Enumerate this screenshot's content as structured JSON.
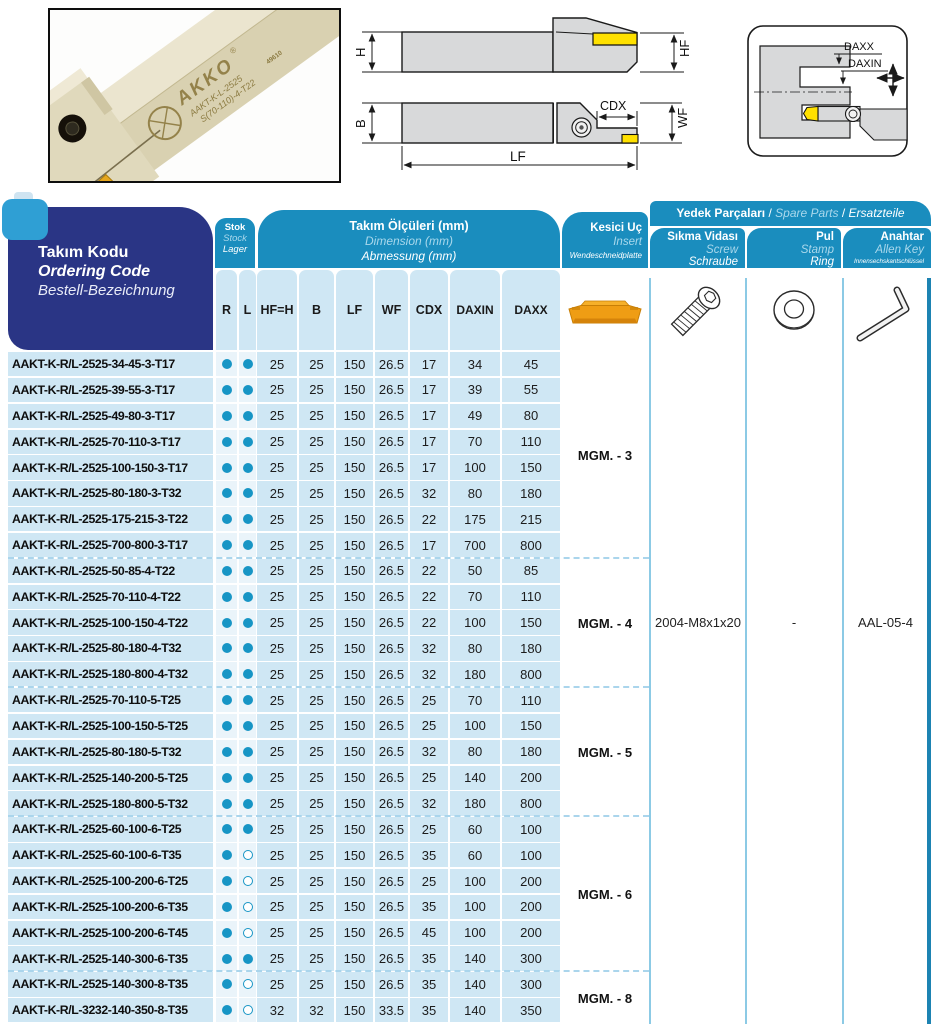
{
  "colors": {
    "teal": "#1a8dbe",
    "navy": "#2a3585",
    "row_blue": "#cfe7f4",
    "dot_teal": "#1795c5",
    "insert_orange": "#ef9d14",
    "drawing_gray": "#d8d9da",
    "insert_yellow": "#ffe100"
  },
  "figures": {
    "photo": {
      "brand": "AKKO",
      "reg": "®",
      "engraving_line1": "AAKT-K-L-2525",
      "engraving_line2": "S(70-110)-4-T22",
      "engraving_line3": "49610"
    },
    "dim_labels": {
      "h": "H",
      "hf": "HF",
      "b": "B",
      "lf": "LF",
      "wf": "WF",
      "cdx": "CDX",
      "daxx": "DAXX",
      "daxin": "DAXIN"
    }
  },
  "header": {
    "ordering_code": {
      "tr": "Takım Kodu",
      "en": "Ordering Code",
      "de": "Bestell-Bezeichnung"
    },
    "stock": {
      "tr": "Stok",
      "en": "Stock",
      "de": "Lager"
    },
    "dimensions": {
      "tr": "Takım Ölçüleri (mm)",
      "en": "Dimension (mm)",
      "de": "Abmessung (mm)"
    },
    "insert": {
      "tr": "Kesici Uç",
      "en": "Insert",
      "de": "Wendeschneidplatte"
    },
    "spare_parts": {
      "tr": "Yedek Parçaları",
      "en": "Spare Parts",
      "de": "Ersatzteile",
      "sep": " / "
    },
    "screw": {
      "tr": "Sıkma Vidası",
      "en": "Screw",
      "de": "Schraube"
    },
    "stamp": {
      "tr": "Pul",
      "en": "Stamp",
      "de": "Ring"
    },
    "allen_key": {
      "tr": "Anahtar",
      "en": "Allen Key",
      "de": "Innensechskantschlüssel"
    },
    "columns": [
      "R",
      "L",
      "HF=H",
      "B",
      "LF",
      "WF",
      "CDX",
      "DAXIN",
      "DAXX"
    ]
  },
  "spare_values": {
    "screw": "2004-M8x1x20",
    "stamp": "-",
    "allen_key": "AAL-05-4"
  },
  "groups": [
    {
      "insert_code": "MGM. - 3",
      "rows": [
        {
          "code": "AAKT-K-R/L-2525-34-45-3-T17",
          "r": "filled",
          "l": "filled",
          "dims": [
            "25",
            "25",
            "150",
            "26.5",
            "17",
            "34",
            "45"
          ]
        },
        {
          "code": "AAKT-K-R/L-2525-39-55-3-T17",
          "r": "filled",
          "l": "filled",
          "dims": [
            "25",
            "25",
            "150",
            "26.5",
            "17",
            "39",
            "55"
          ]
        },
        {
          "code": "AAKT-K-R/L-2525-49-80-3-T17",
          "r": "filled",
          "l": "filled",
          "dims": [
            "25",
            "25",
            "150",
            "26.5",
            "17",
            "49",
            "80"
          ]
        },
        {
          "code": "AAKT-K-R/L-2525-70-110-3-T17",
          "r": "filled",
          "l": "filled",
          "dims": [
            "25",
            "25",
            "150",
            "26.5",
            "17",
            "70",
            "110"
          ]
        },
        {
          "code": "AAKT-K-R/L-2525-100-150-3-T17",
          "r": "filled",
          "l": "filled",
          "dims": [
            "25",
            "25",
            "150",
            "26.5",
            "17",
            "100",
            "150"
          ]
        },
        {
          "code": "AAKT-K-R/L-2525-80-180-3-T32",
          "r": "filled",
          "l": "filled",
          "dims": [
            "25",
            "25",
            "150",
            "26.5",
            "32",
            "80",
            "180"
          ]
        },
        {
          "code": "AAKT-K-R/L-2525-175-215-3-T22",
          "r": "filled",
          "l": "filled",
          "dims": [
            "25",
            "25",
            "150",
            "26.5",
            "22",
            "175",
            "215"
          ]
        },
        {
          "code": "AAKT-K-R/L-2525-700-800-3-T17",
          "r": "filled",
          "l": "filled",
          "dims": [
            "25",
            "25",
            "150",
            "26.5",
            "17",
            "700",
            "800"
          ]
        }
      ]
    },
    {
      "insert_code": "MGM. - 4",
      "rows": [
        {
          "code": "AAKT-K-R/L-2525-50-85-4-T22",
          "r": "filled",
          "l": "filled",
          "dims": [
            "25",
            "25",
            "150",
            "26.5",
            "22",
            "50",
            "85"
          ]
        },
        {
          "code": "AAKT-K-R/L-2525-70-110-4-T22",
          "r": "filled",
          "l": "filled",
          "dims": [
            "25",
            "25",
            "150",
            "26.5",
            "22",
            "70",
            "110"
          ]
        },
        {
          "code": "AAKT-K-R/L-2525-100-150-4-T22",
          "r": "filled",
          "l": "filled",
          "dims": [
            "25",
            "25",
            "150",
            "26.5",
            "22",
            "100",
            "150"
          ]
        },
        {
          "code": "AAKT-K-R/L-2525-80-180-4-T32",
          "r": "filled",
          "l": "filled",
          "dims": [
            "25",
            "25",
            "150",
            "26.5",
            "32",
            "80",
            "180"
          ]
        },
        {
          "code": "AAKT-K-R/L-2525-180-800-4-T32",
          "r": "filled",
          "l": "filled",
          "dims": [
            "25",
            "25",
            "150",
            "26.5",
            "32",
            "180",
            "800"
          ]
        }
      ]
    },
    {
      "insert_code": "MGM. - 5",
      "rows": [
        {
          "code": "AAKT-K-R/L-2525-70-110-5-T25",
          "r": "filled",
          "l": "filled",
          "dims": [
            "25",
            "25",
            "150",
            "26.5",
            "25",
            "70",
            "110"
          ]
        },
        {
          "code": "AAKT-K-R/L-2525-100-150-5-T25",
          "r": "filled",
          "l": "filled",
          "dims": [
            "25",
            "25",
            "150",
            "26.5",
            "25",
            "100",
            "150"
          ]
        },
        {
          "code": "AAKT-K-R/L-2525-80-180-5-T32",
          "r": "filled",
          "l": "filled",
          "dims": [
            "25",
            "25",
            "150",
            "26.5",
            "32",
            "80",
            "180"
          ]
        },
        {
          "code": "AAKT-K-R/L-2525-140-200-5-T25",
          "r": "filled",
          "l": "filled",
          "dims": [
            "25",
            "25",
            "150",
            "26.5",
            "25",
            "140",
            "200"
          ]
        },
        {
          "code": "AAKT-K-R/L-2525-180-800-5-T32",
          "r": "filled",
          "l": "filled",
          "dims": [
            "25",
            "25",
            "150",
            "26.5",
            "32",
            "180",
            "800"
          ]
        }
      ]
    },
    {
      "insert_code": "MGM. - 6",
      "rows": [
        {
          "code": "AAKT-K-R/L-2525-60-100-6-T25",
          "r": "filled",
          "l": "filled",
          "dims": [
            "25",
            "25",
            "150",
            "26.5",
            "25",
            "60",
            "100"
          ]
        },
        {
          "code": "AAKT-K-R/L-2525-60-100-6-T35",
          "r": "filled",
          "l": "open",
          "dims": [
            "25",
            "25",
            "150",
            "26.5",
            "35",
            "60",
            "100"
          ]
        },
        {
          "code": "AAKT-K-R/L-2525-100-200-6-T25",
          "r": "filled",
          "l": "open",
          "dims": [
            "25",
            "25",
            "150",
            "26.5",
            "25",
            "100",
            "200"
          ]
        },
        {
          "code": "AAKT-K-R/L-2525-100-200-6-T35",
          "r": "filled",
          "l": "open",
          "dims": [
            "25",
            "25",
            "150",
            "26.5",
            "35",
            "100",
            "200"
          ]
        },
        {
          "code": "AAKT-K-R/L-2525-100-200-6-T45",
          "r": "filled",
          "l": "open",
          "dims": [
            "25",
            "25",
            "150",
            "26.5",
            "45",
            "100",
            "200"
          ]
        },
        {
          "code": "AAKT-K-R/L-2525-140-300-6-T35",
          "r": "filled",
          "l": "filled",
          "dims": [
            "25",
            "25",
            "150",
            "26.5",
            "35",
            "140",
            "300"
          ]
        }
      ]
    },
    {
      "insert_code": "MGM. - 8",
      "rows": [
        {
          "code": "AAKT-K-R/L-2525-140-300-8-T35",
          "r": "filled",
          "l": "open",
          "dims": [
            "25",
            "25",
            "150",
            "26.5",
            "35",
            "140",
            "300"
          ]
        },
        {
          "code": "AAKT-K-R/L-3232-140-350-8-T35",
          "r": "filled",
          "l": "open",
          "dims": [
            "32",
            "32",
            "150",
            "33.5",
            "35",
            "140",
            "350"
          ]
        }
      ]
    }
  ]
}
